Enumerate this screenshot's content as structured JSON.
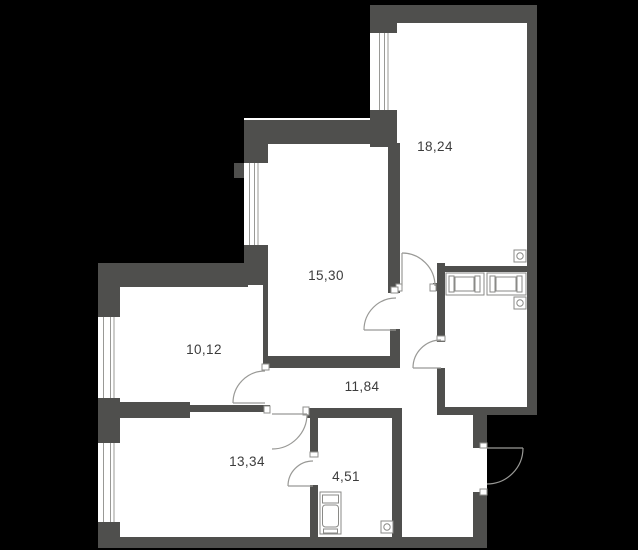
{
  "title": "apartment-floorplan",
  "colors": {
    "background": "#000000",
    "wall": "#4f4f4d",
    "floor": "#ffffff",
    "thin_line": "#999996",
    "text": "#3c3c3c"
  },
  "rooms": [
    {
      "name": "room-top-right",
      "area_label": "18,24"
    },
    {
      "name": "room-middle",
      "area_label": "15,30"
    },
    {
      "name": "room-left",
      "area_label": "10,12"
    },
    {
      "name": "hallway",
      "area_label": "11,84"
    },
    {
      "name": "room-bottom-left",
      "area_label": "13,34"
    },
    {
      "name": "bathroom",
      "area_label": "4,51"
    }
  ],
  "fixtures": {
    "wardrobe_sections": 2,
    "vent_icons": 3,
    "washing_machine": 1,
    "windows": 4,
    "door_arcs": 7
  }
}
